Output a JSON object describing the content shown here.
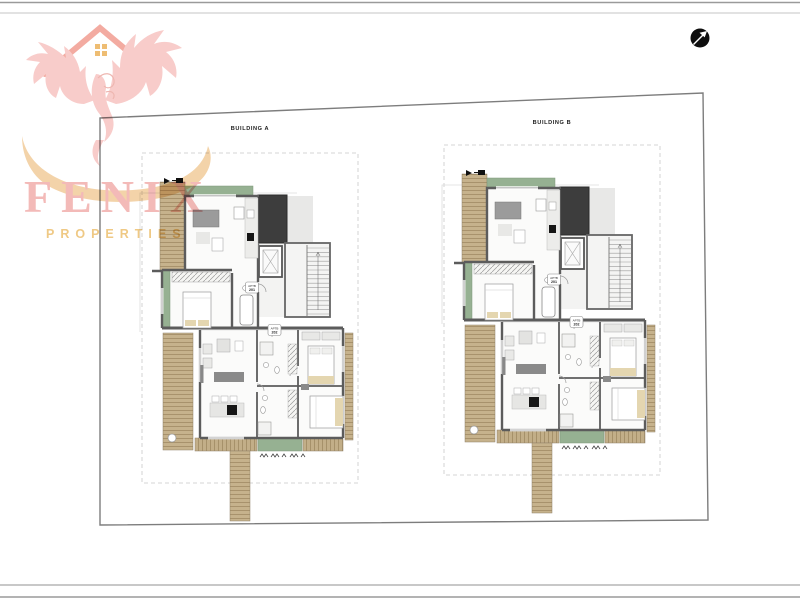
{
  "page": {
    "background": "#ffffff"
  },
  "frame": {
    "outer_line_color": "#9a9a9a",
    "inner_line_color": "#c6c6c6"
  },
  "north_arrow": {
    "circle_color": "#0e0e0e",
    "arrow_color": "#ffffff"
  },
  "site": {
    "boundary_color": "#7d7d7d",
    "setback_dash_color": "#c9c9c9"
  },
  "logo": {
    "name": "FENIX",
    "subtitle": "PROPERTIES",
    "name_color": "#ef9f9d",
    "subtitle_color": "#e9b455",
    "phoenix_color": "#f5b9b6",
    "roof_color": "#ee8b7d",
    "window_color": "#e8a33d",
    "swoosh_color": "#eec287"
  },
  "plan_colors": {
    "wall": "#5c5c5c",
    "floor": "#fbfbfa",
    "wood": "#c6b28c",
    "wood_line": "#a08a63",
    "green": "#96b192",
    "dark_panel": "#3d3d3d",
    "shadow": "#e8e8e7",
    "furniture_light": "#e9e9e7",
    "furniture_dark": "#8f8f8f",
    "cooktop": "#161616",
    "bed_accent": "#e4d6b0"
  },
  "buildings": [
    {
      "label": "BUILDING A",
      "apartments": [
        {
          "line1": "APTB",
          "line2": "201"
        },
        {
          "line1": "APTB",
          "line2": "202"
        }
      ]
    },
    {
      "label": "BUILDING B",
      "apartments": [
        {
          "line1": "APTB",
          "line2": "201"
        },
        {
          "line1": "APTB",
          "line2": "202"
        }
      ]
    }
  ]
}
